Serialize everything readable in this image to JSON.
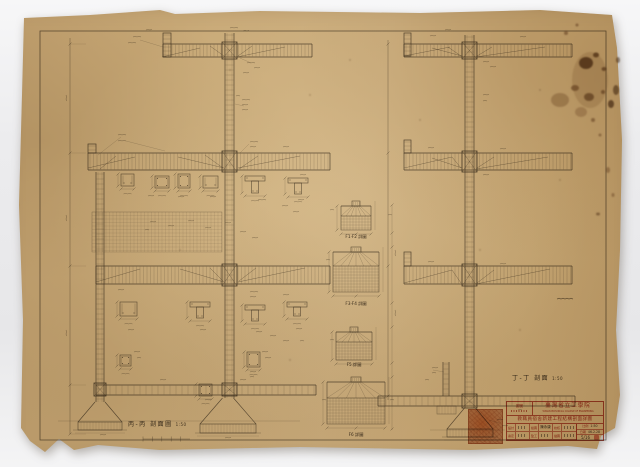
{
  "sections": {
    "left_title": "丙-丙 剖面圖",
    "left_scale": "1:50",
    "right_title": "丁-丁 剖面",
    "right_scale": "1:50"
  },
  "footing_details": {
    "captions": [
      "F1·F2 詳圖",
      "F3·F4 詳圖",
      "F5 詳圖",
      "F6 詳圖"
    ]
  },
  "title_block": {
    "no_label": "圖號",
    "org": "臺灣省立工學院",
    "org_en": "TAIWAN PROVINCIAL COLLEGE OF ENGINEERING",
    "project": "教職員宿舍新建工程結構剖面詳圖",
    "fields": [
      {
        "label": "設計",
        "value": ""
      },
      {
        "label": "繪圖",
        "value": "陳永康"
      },
      {
        "label": "校核",
        "value": ""
      },
      {
        "label": "審定",
        "value": ""
      },
      {
        "label": "監工",
        "value": ""
      },
      {
        "label": "描圖",
        "value": ""
      }
    ],
    "scale_label": "比例",
    "scale": "1:50",
    "date_label": "日期",
    "date": "46.2.28",
    "sheet": "5/16"
  }
}
